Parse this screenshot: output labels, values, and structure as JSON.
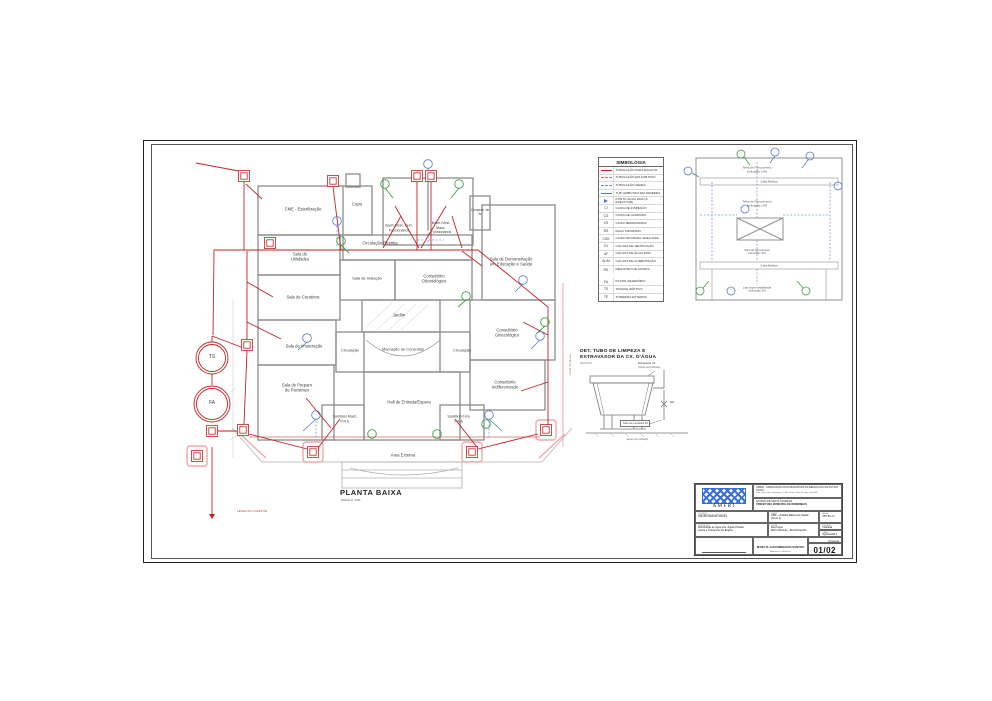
{
  "page": {
    "plan_title": "PLANTA BAIXA",
    "plan_scale": "ESCALA: 1/50"
  },
  "plan": {
    "rooms": [
      {
        "label": "CME - Esterilização"
      },
      {
        "label": "Copa"
      },
      {
        "label": "Banh./Vest. Fem. Funcionários"
      },
      {
        "label": "Banh./Vest. Masc. Funcionários"
      },
      {
        "label": "Compres. de Ar"
      },
      {
        "label": "Sala de Utilidades"
      },
      {
        "label": "Circulação Restrita"
      },
      {
        "label": "Sala de Inalação"
      },
      {
        "label": "Consultório Odontológico"
      },
      {
        "label": "Sala de Demonstração em Educação e Saúde"
      },
      {
        "label": "Sala de Curativos"
      },
      {
        "label": "Jardim"
      },
      {
        "label": "Sala de Imunização"
      },
      {
        "label": "Circulação"
      },
      {
        "label": "Marcação de Consultas"
      },
      {
        "label": "Circulação"
      },
      {
        "label": "Consultório Ginecológico"
      },
      {
        "label": "Sala de Preparo de Pacientes"
      },
      {
        "label": "Consultório Indiferenciado"
      },
      {
        "label": "Hall de Entrada/Espera"
      },
      {
        "label": "Sanitário Masc. P.N.E"
      },
      {
        "label": "Sanitário Fem. P.N.E"
      },
      {
        "label": "Área Externa"
      }
    ],
    "tanks": {
      "ts": "TS",
      "fa": "FA"
    },
    "notes": {
      "levar_ao_coletor": "LEVAR AO COLETOR",
      "linha_divisa": "Linha de Divisa"
    }
  },
  "legend": {
    "title": "SIMBOLOGIA",
    "rows": [
      {
        "code": "",
        "label": "TUBULAÇÃO PARA ESGOTO"
      },
      {
        "code": "",
        "label": "TUBULAÇÃO EM SUB-PISO"
      },
      {
        "code": "",
        "label": "TUBULAÇÃO AÉREA"
      },
      {
        "code": "",
        "label": "TUB. EMBUTIDA EM PAREDES"
      },
      {
        "code": "",
        "label": "PONTO ÁGUA FRIA (A EXECUTAR)"
      },
      {
        "code": "CI",
        "label": "CAIXA DE INSPEÇÃO"
      },
      {
        "code": "CG",
        "label": "CAIXA DE GORDURA"
      },
      {
        "code": "CS",
        "label": "CAIXA SEPARADORA"
      },
      {
        "code": "RS",
        "label": "RALO SIFONADO"
      },
      {
        "code": "CSG",
        "label": "CAIXA SIFONADA GRELHADA"
      },
      {
        "code": "CV",
        "label": "COLUNA DE VENTILAÇÃO"
      },
      {
        "code": "AF",
        "label": "COLUNA DE ÁGUA FRIA"
      },
      {
        "code": "ALIM",
        "label": "COLUNA DE ALIMENTAÇÃO"
      },
      {
        "code": "RG",
        "label": "REGISTRO DE GAVETA"
      },
      {
        "code": "FA",
        "label": "FILTRO ANAERÓBIO"
      },
      {
        "code": "TS",
        "label": "TANQUE SÉPTICO"
      },
      {
        "code": "TE",
        "label": "TORNEIRA EXTERNA"
      }
    ]
  },
  "roof": {
    "telha_line1": "Telha de Fibrocimento",
    "telha_line2": "Inclinação 10%",
    "calha": "Calha Metálica",
    "laje_line1": "Laje Impermeabilizada",
    "laje_line2": "Inclinação 2%"
  },
  "detail": {
    "title_line1": "DET. TUBO DE LIMPEZA E",
    "title_line2": "EXTRAVASOR DA CX. D'ÁGUA",
    "scale_note": "S/ESCALA",
    "extravasor_line1": "Extravasor 32",
    "extravasor_line2": "(vazar pelo telhado)",
    "rg": "RG",
    "tubo": "Tubo de Limpeza 32",
    "tubo_sub": "(vazar pelo telhado)"
  },
  "title_block": {
    "org_name": "AMFRI - ASSOCIAÇÃO DOS MUNICÍPIOS DA REGIÃO DA FOZ DO RIO ITAJAÍ",
    "org_address": "Rua Luiz Lopes Gonzaga, nº 655, Bairro São Vicente - Itajaí/SC",
    "gov_line1": "ESTADO DE SANTA CATARINA",
    "gov_line2": "PREFEITURA MUNICIPAL DE BOMBINHAS",
    "logo_text": "AMFRI",
    "fields": {
      "projeto_label": "PROJETO",
      "projeto": "HIDROSANITÁRIO",
      "obra_label": "OBRA",
      "obra": "UBS - Unidade Básica de Saúde (Porte 1)",
      "area_label": "ÁREA",
      "area": "257,81 m²",
      "conteudo_label": "CONTEÚDO",
      "conteudo_line1": "Distribuição de Água Fria, Águas Pluviais",
      "conteudo_line2": "Coleta e Tratamento de Esgoto",
      "local_label": "LOCAL",
      "local_line1": "Rua Coqui",
      "local_line2": "Bairro Bombas - Bombinhas/SC",
      "escala_label": "ESCALA",
      "escala": "Indicada",
      "data_label": "DATA",
      "data": "Agosto/2013",
      "assinatura": "Prefeito Municipal",
      "resp_name": "MARA R. GIACOMINI DOS SANTOS",
      "resp_title": "Arquiteta e Urbanista",
      "desenho_label": "DESENHO",
      "desenho": "M.Garcia",
      "folha_label": "FOLHA",
      "folha": "01/02"
    }
  }
}
